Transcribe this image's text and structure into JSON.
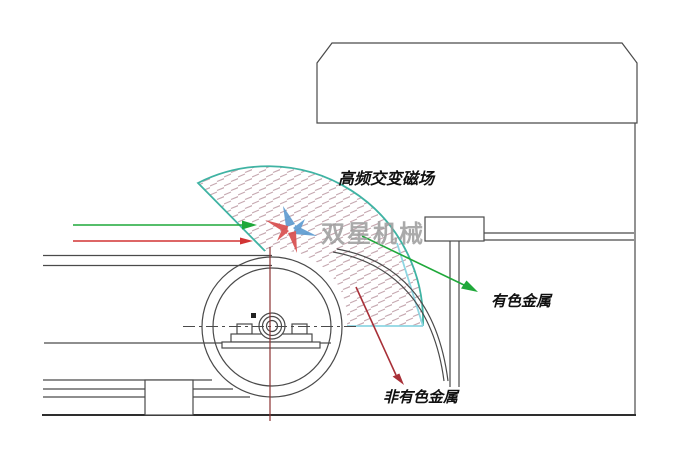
{
  "diagram": {
    "type": "eddy-current-separator-schematic",
    "labels": {
      "magnetic_field": "高频交变磁场",
      "nonferrous_metal": "有色金属",
      "non_nonferrous_metal": "非有色金属"
    },
    "watermark": {
      "text": "双星机械"
    },
    "colors": {
      "line": "#4a4a4a",
      "line-dark": "#2e2e2e",
      "teal": "#3fb3a3",
      "cyan": "#8fd6e2",
      "green": "#1fa83a",
      "red": "#d23434",
      "dark-red": "#a83038",
      "maroon": "#8b3333",
      "hatch": "#c6a9b1",
      "watermark-gray": "#9c9c9c",
      "logo-blue": "#5b9ad0",
      "logo-red": "#d84b4b"
    }
  }
}
